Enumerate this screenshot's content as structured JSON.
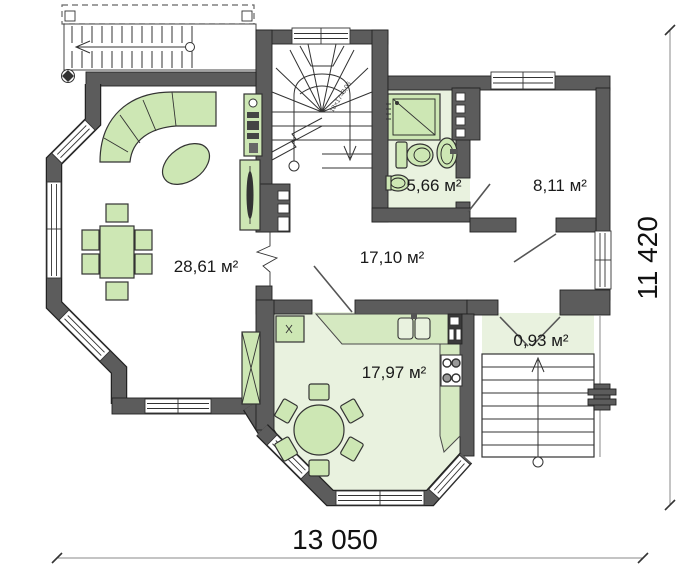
{
  "plan": {
    "type": "floor-plan",
    "rooms": {
      "living": {
        "name": "living-room",
        "area": "28,61 м²"
      },
      "hall": {
        "name": "hall",
        "area": "17,10 м²"
      },
      "bath": {
        "name": "bathroom",
        "area": "5,66 м²"
      },
      "room": {
        "name": "room",
        "area": "8,11 м²"
      },
      "kitchen": {
        "name": "kitchen",
        "area": "17,97 м²"
      },
      "porch": {
        "name": "entry-porch",
        "area": "0,93 м²"
      }
    },
    "dimensions": {
      "width_label": "13 050",
      "height_label": "11 420"
    },
    "stairs": {
      "note": "18×17=3,06"
    },
    "colors": {
      "wall": "#5c5c5c",
      "furniture_green": "#cde7b4",
      "floor_green": "#e9f2df",
      "counter_green": "#d5e9c1",
      "background": "#ffffff"
    }
  }
}
